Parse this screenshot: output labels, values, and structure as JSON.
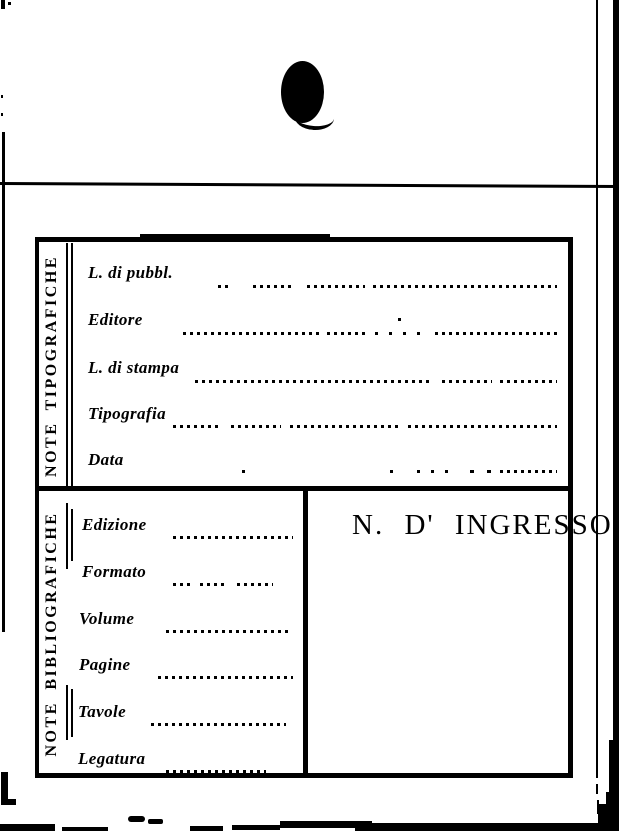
{
  "colors": {
    "ink": "#000000",
    "paper": "#ffffff"
  },
  "card": {
    "tipografiche": {
      "title": "NOTE TIPOGRAFICHE",
      "fields": [
        "L. di pubbl.",
        "Editore",
        "L. di stampa",
        "Tipografia",
        "Data"
      ]
    },
    "bibliografiche": {
      "title": "NOTE BIBLIOGRAFICHE",
      "fields": [
        "Edizione",
        "Formato",
        "Volume",
        "Pagine",
        "Tavole",
        "Legatura"
      ]
    },
    "ingresso": "N.  D' INGRESSO"
  }
}
